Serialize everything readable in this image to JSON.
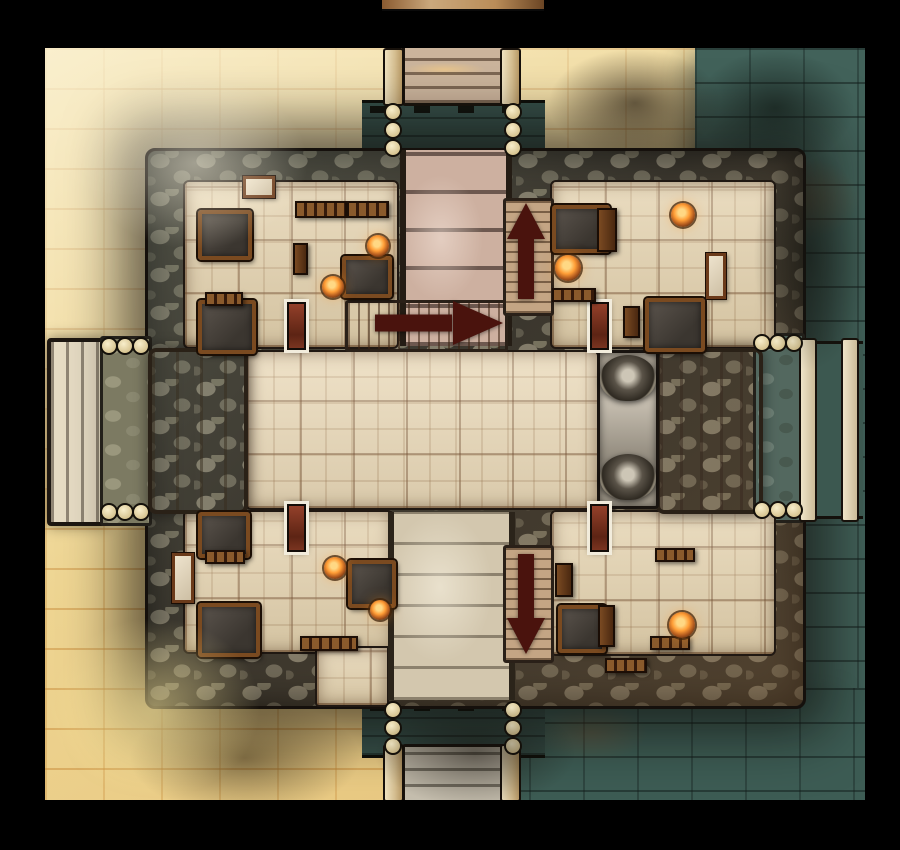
{
  "meta": {
    "grid_size_px": 53
  },
  "colors": {
    "frame": "#000000",
    "sand_light": "#f3e6c0",
    "sand_gold": "#eac36e",
    "sand_mortar": "#c07f2e",
    "teal_stone": "#42625a",
    "rock_wall": "#6f6a58",
    "rock_gap": "#2e2a22",
    "tile_floor": "#e6d4b0",
    "grid_line": "#5e3a1c",
    "plank_pink": "#cdb0a0",
    "stair_tan": "#c29d7c",
    "slab_cream": "#e9dfcc",
    "monument_grey": "#a8a196",
    "wood": "#74431d",
    "arrow": "#4a130d",
    "door_fill": "#8a3a22",
    "door_frame": "#f2ecdc",
    "brazier": "#ff9d36",
    "post": "#ecdfba"
  },
  "map": {
    "arrows": [
      {
        "dir": "right",
        "name": "stairs-east-arrow",
        "x": 330,
        "y": 252,
        "w": 128,
        "h": 46
      },
      {
        "dir": "up",
        "name": "stairs-up-arrow",
        "x": 456,
        "y": 155,
        "w": 50,
        "h": 96
      },
      {
        "dir": "down",
        "name": "stairs-down-arrow",
        "x": 456,
        "y": 506,
        "w": 50,
        "h": 100
      }
    ],
    "objects": [
      {
        "t": "door",
        "name": "door-northwest",
        "x": 242,
        "y": 254,
        "w": 15,
        "h": 44
      },
      {
        "t": "door",
        "name": "door-northeast",
        "x": 545,
        "y": 254,
        "w": 15,
        "h": 44
      },
      {
        "t": "door",
        "name": "door-southwest",
        "x": 242,
        "y": 456,
        "w": 15,
        "h": 44
      },
      {
        "t": "door",
        "name": "door-southeast",
        "x": 545,
        "y": 456,
        "w": 15,
        "h": 44
      },
      {
        "t": "table",
        "x": 153,
        "y": 162,
        "w": 46,
        "h": 42
      },
      {
        "t": "table",
        "x": 297,
        "y": 208,
        "w": 42,
        "h": 34
      },
      {
        "t": "table",
        "x": 153,
        "y": 252,
        "w": 50,
        "h": 46
      },
      {
        "t": "table",
        "x": 507,
        "y": 157,
        "w": 50,
        "h": 40
      },
      {
        "t": "table",
        "x": 600,
        "y": 250,
        "w": 52,
        "h": 46
      },
      {
        "t": "table",
        "x": 153,
        "y": 464,
        "w": 44,
        "h": 38
      },
      {
        "t": "table",
        "x": 153,
        "y": 555,
        "w": 54,
        "h": 46
      },
      {
        "t": "table",
        "x": 303,
        "y": 512,
        "w": 40,
        "h": 40
      },
      {
        "t": "table",
        "x": 513,
        "y": 557,
        "w": 40,
        "h": 40
      },
      {
        "t": "bed",
        "x": 127,
        "y": 505,
        "w": 16,
        "h": 44
      },
      {
        "t": "bed",
        "x": 198,
        "y": 128,
        "w": 26,
        "h": 16
      },
      {
        "t": "bed",
        "x": 661,
        "y": 205,
        "w": 14,
        "h": 40
      },
      {
        "t": "shelf",
        "x": 250,
        "y": 153,
        "w": 48,
        "h": 13
      },
      {
        "t": "shelf",
        "x": 302,
        "y": 153,
        "w": 38,
        "h": 13
      },
      {
        "t": "shelf",
        "x": 160,
        "y": 244,
        "w": 34,
        "h": 10
      },
      {
        "t": "shelf",
        "x": 507,
        "y": 240,
        "w": 40,
        "h": 10
      },
      {
        "t": "shelf",
        "x": 160,
        "y": 502,
        "w": 36,
        "h": 10
      },
      {
        "t": "shelf",
        "x": 255,
        "y": 588,
        "w": 54,
        "h": 11
      },
      {
        "t": "shelf",
        "x": 610,
        "y": 500,
        "w": 36,
        "h": 10
      },
      {
        "t": "shelf",
        "x": 605,
        "y": 588,
        "w": 36,
        "h": 10
      },
      {
        "t": "shelf",
        "x": 560,
        "y": 610,
        "w": 38,
        "h": 11
      },
      {
        "t": "cabinet",
        "x": 552,
        "y": 160,
        "w": 16,
        "h": 40
      },
      {
        "t": "cabinet",
        "x": 578,
        "y": 258,
        "w": 13,
        "h": 28
      },
      {
        "t": "cabinet",
        "x": 510,
        "y": 515,
        "w": 14,
        "h": 30
      },
      {
        "t": "cabinet",
        "x": 553,
        "y": 557,
        "w": 13,
        "h": 38
      },
      {
        "t": "cabinet",
        "x": 248,
        "y": 195,
        "w": 11,
        "h": 28
      },
      {
        "t": "brazier",
        "x": 322,
        "y": 187,
        "w": 22,
        "h": 22
      },
      {
        "t": "brazier",
        "x": 277,
        "y": 228,
        "w": 22,
        "h": 22
      },
      {
        "t": "brazier",
        "x": 510,
        "y": 207,
        "w": 26,
        "h": 26
      },
      {
        "t": "brazier",
        "x": 626,
        "y": 155,
        "w": 24,
        "h": 24
      },
      {
        "t": "brazier",
        "x": 279,
        "y": 509,
        "w": 22,
        "h": 22
      },
      {
        "t": "brazier",
        "x": 325,
        "y": 552,
        "w": 20,
        "h": 20
      },
      {
        "t": "brazier",
        "x": 624,
        "y": 564,
        "w": 26,
        "h": 26
      }
    ],
    "posts": [
      {
        "x": 346,
        "y": 62,
        "dx": 0,
        "dy": 18,
        "n": 3
      },
      {
        "x": 466,
        "y": 62,
        "dx": 0,
        "dy": 18,
        "n": 3
      },
      {
        "x": 346,
        "y": 660,
        "dx": 0,
        "dy": 18,
        "n": 3
      },
      {
        "x": 466,
        "y": 660,
        "dx": 0,
        "dy": 18,
        "n": 3
      },
      {
        "x": 62,
        "y": 296,
        "dx": 16,
        "dy": 0,
        "n": 3
      },
      {
        "x": 62,
        "y": 462,
        "dx": 16,
        "dy": 0,
        "n": 3
      },
      {
        "x": 715,
        "y": 293,
        "dx": 16,
        "dy": 0,
        "n": 3
      },
      {
        "x": 715,
        "y": 460,
        "dx": 16,
        "dy": 0,
        "n": 3
      }
    ]
  }
}
